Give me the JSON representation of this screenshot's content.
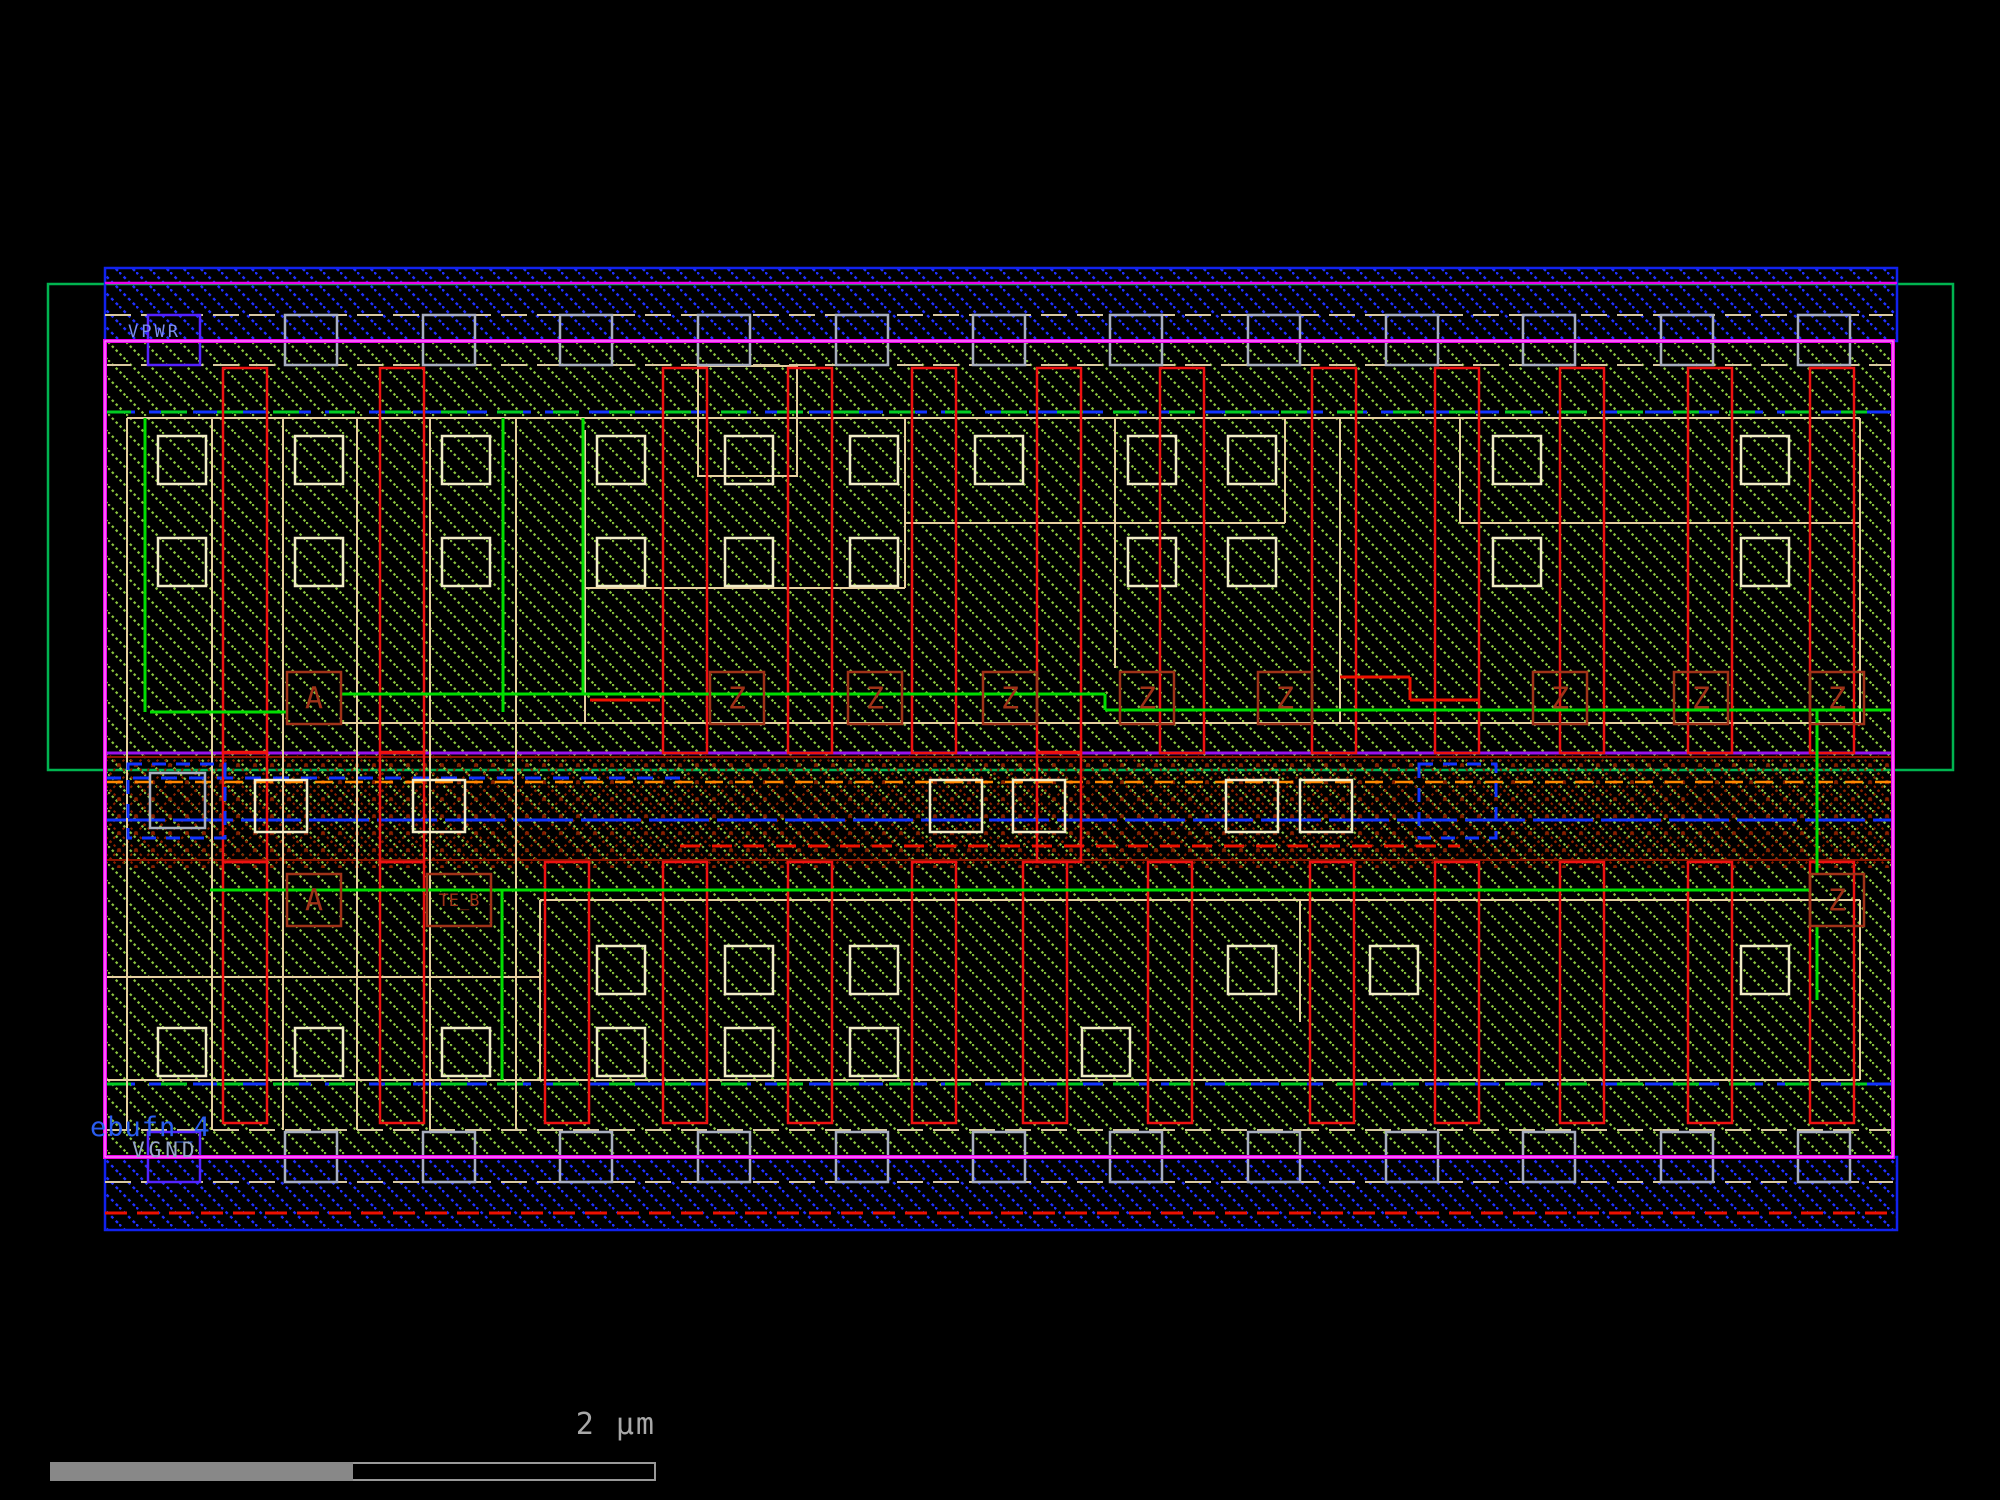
{
  "view": {
    "width": 2000,
    "height": 1500,
    "background": "#000000"
  },
  "labels": {
    "vpwr": {
      "text": "VPWR",
      "x": 128,
      "y": 324,
      "color": "#7b8cf0"
    },
    "cellname": {
      "text": "ebufn_4",
      "x": 90,
      "y": 1114,
      "color": "#2a5cf0"
    },
    "vgnd": {
      "text": "VGND",
      "x": 132,
      "y": 1140,
      "color": "#96a5c8"
    }
  },
  "scalebar": {
    "label": "2 µm",
    "color": "#a8a8a8",
    "bar": {
      "x": 50,
      "y": 1462,
      "width": 606,
      "height": 19,
      "filled_width": 303,
      "fill": "#888888",
      "outline": "#999999"
    },
    "label_pos": {
      "x": 560,
      "y": 1410,
      "width": 96
    }
  },
  "palette": {
    "nwell": "#00b450",
    "metal_hatch": "#2030ff",
    "metal_border": "#1122ee",
    "hatch_green": "#8cc73f",
    "poly": "#ee1111",
    "diff": "#e6cfa0",
    "contact": "#f2ecc8",
    "mcon": "#a8aec0",
    "pin_box": "#5522ff",
    "boundary": "#ee00ee",
    "boundary_core": "#ff9bff",
    "label_red": "#a03218",
    "net_green": "#00dd00",
    "purple": "#9911ee",
    "dark_red": "#8a1500",
    "orange": "#ff8800",
    "blue": "#1133ff",
    "red_x": "#8a2000",
    "li_dash": "#d8c8a0",
    "red_dash": "#ee1100"
  },
  "pins": {
    "box": {
      "w": 54,
      "h": 52
    },
    "upper_row": {
      "y": 672,
      "a_x": 287,
      "a_label": "A",
      "z_label": "Z",
      "z_xs": [
        710,
        848,
        983,
        1120,
        1258,
        1533,
        1674,
        1810
      ]
    },
    "lower_row": {
      "y": 874,
      "a_x": 287,
      "a_label": "A",
      "teb": {
        "x": 427,
        "w": 64,
        "label": "TE_B"
      },
      "z_x": 1810,
      "z_label": "Z"
    }
  },
  "geometry": {
    "nwell": [
      48,
      284,
      1905,
      486
    ],
    "rail_top": [
      105,
      268,
      1792,
      73
    ],
    "rail_bottom": [
      105,
      1157,
      1792,
      73
    ],
    "body": [
      105,
      341,
      1788,
      816
    ],
    "channel": [
      105,
      752,
      1788,
      116
    ],
    "boundary_line_top_y": 283,
    "rail_red_line_y": 1213,
    "blue_green_lines_y": [
      412,
      1084
    ],
    "li_dash_rows_y": [
      315,
      365,
      1130,
      1182
    ],
    "mcon": {
      "w": 52,
      "h": 50,
      "rows_y": [
        315,
        1132
      ],
      "xs": [
        148,
        285,
        423,
        560,
        698,
        836,
        973,
        1110,
        1248,
        1386,
        1523,
        1661,
        1798
      ],
      "pin_index": 0
    },
    "poly": {
      "w": 44,
      "upper": {
        "y": 368,
        "h": 385,
        "xs": [
          223,
          380,
          663,
          788,
          912,
          1037,
          1160,
          1312,
          1435,
          1560,
          1688,
          1810
        ]
      },
      "lower": {
        "y": 862,
        "h": 261,
        "xs": [
          223,
          380,
          545,
          663,
          788,
          912,
          1023,
          1148,
          1310,
          1435,
          1560,
          1688,
          1810
        ]
      },
      "cross": {
        "y": 752,
        "h": 110,
        "xs": [
          223,
          380,
          1037
        ]
      }
    },
    "diff_hlines": [
      [
        127,
        418,
        1860,
        418
      ],
      [
        905,
        523,
        1285,
        523
      ],
      [
        1460,
        523,
        1860,
        523
      ],
      [
        585,
        588,
        905,
        588
      ],
      [
        340,
        723,
        1860,
        723
      ],
      [
        540,
        900,
        1860,
        900
      ],
      [
        105,
        977,
        540,
        977
      ],
      [
        105,
        1080,
        1860,
        1080
      ]
    ],
    "diff_vlines": [
      [
        127,
        418,
        127,
        1130
      ],
      [
        212,
        418,
        212,
        1130
      ],
      [
        283,
        418,
        283,
        1130
      ],
      [
        357,
        418,
        357,
        1130
      ],
      [
        430,
        418,
        430,
        1130
      ],
      [
        516,
        418,
        516,
        1130
      ],
      [
        585,
        430,
        585,
        723
      ],
      [
        905,
        418,
        905,
        588
      ],
      [
        1115,
        418,
        1115,
        668
      ],
      [
        1285,
        418,
        1285,
        523
      ],
      [
        1340,
        418,
        1340,
        723
      ],
      [
        1460,
        418,
        1460,
        523
      ],
      [
        1860,
        418,
        1860,
        723
      ],
      [
        540,
        900,
        540,
        1080
      ],
      [
        1300,
        900,
        1300,
        1022
      ],
      [
        1860,
        900,
        1860,
        1080
      ]
    ],
    "diff_notch": [
      698,
      366,
      99,
      110
    ],
    "contacts": {
      "size": 48,
      "rows": [
        {
          "y": 436,
          "xs": [
            158,
            295,
            442,
            597,
            725,
            850,
            975,
            1128,
            1228,
            1493,
            1741
          ]
        },
        {
          "y": 538,
          "xs": [
            158,
            295,
            442,
            597,
            725,
            850,
            1128,
            1228,
            1493,
            1741
          ]
        },
        {
          "y": 946,
          "xs": [
            597,
            725,
            850,
            1228,
            1370,
            1741
          ]
        },
        {
          "y": 1028,
          "xs": [
            158,
            295,
            442,
            597,
            725,
            850,
            1082
          ]
        }
      ]
    },
    "channel_boxes": {
      "y": 780,
      "size": 52,
      "xs": [
        255,
        413,
        930,
        1013,
        1226,
        1300
      ]
    },
    "channel_gray_box": [
      150,
      773,
      55,
      55
    ],
    "channel_pin_boxes": [
      [
        128,
        764,
        97,
        74
      ],
      [
        1419,
        764,
        77,
        74
      ]
    ],
    "channel_lines": {
      "purple_y": 753,
      "dark_red_y": [
        757,
        860
      ],
      "orange_y": 782,
      "blue_dash": [
        778,
        105,
        680
      ],
      "blue_y": 820,
      "red_dash": [
        846,
        680,
        1460
      ]
    },
    "nets_green": [
      [
        150,
        712,
        287,
        712
      ],
      [
        341,
        694,
        1105,
        694
      ],
      [
        1105,
        694,
        1105,
        710
      ],
      [
        1105,
        710,
        1893,
        710
      ],
      [
        583,
        418,
        583,
        694
      ],
      [
        145,
        418,
        145,
        712
      ],
      [
        503,
        418,
        503,
        712
      ],
      [
        210,
        890,
        1810,
        890
      ],
      [
        502,
        890,
        502,
        1080
      ],
      [
        1817,
        710,
        1817,
        874
      ],
      [
        1817,
        926,
        1817,
        1000
      ]
    ],
    "nets_red": [
      [
        1340,
        677,
        1410,
        677
      ],
      [
        1410,
        677,
        1410,
        700
      ],
      [
        1410,
        700,
        1480,
        700
      ],
      [
        590,
        700,
        660,
        700
      ]
    ]
  }
}
